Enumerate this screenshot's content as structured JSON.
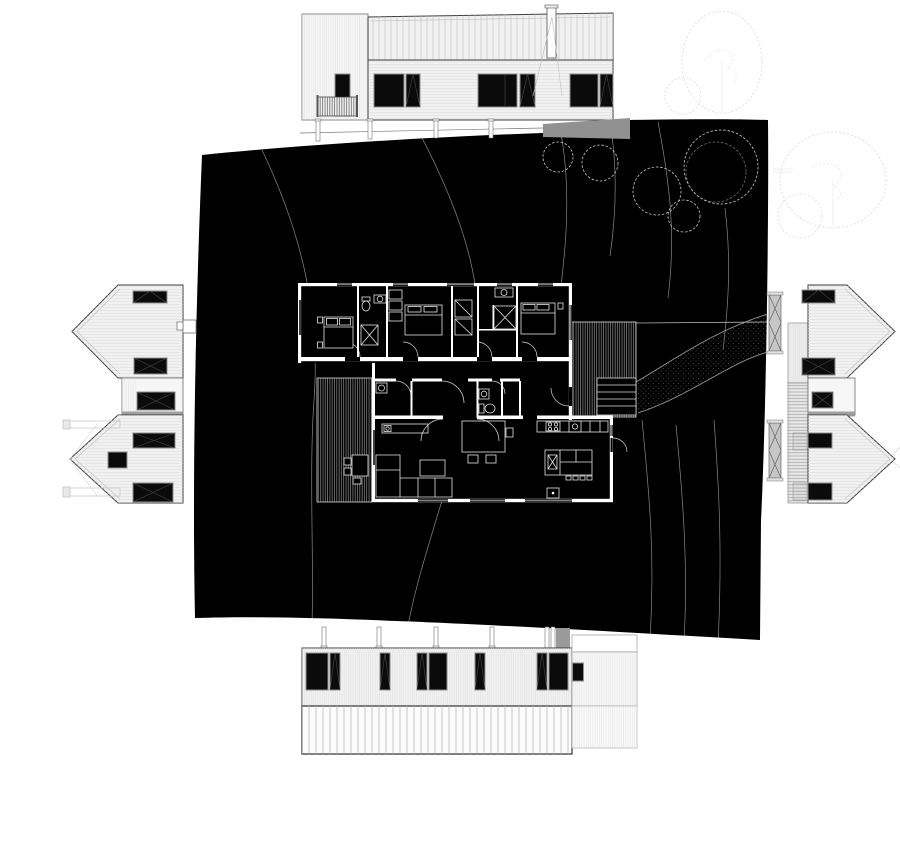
{
  "colors": {
    "paper": "#ffffff",
    "site": "#000000",
    "contour": "#8a8a8a",
    "plan-line": "#e4e4e4",
    "wall": "#ffffff",
    "elev-fill": "#f1f1f1",
    "elev-line": "#3c3c3c",
    "glass": "#0b0b0b",
    "frame": "#8f8f8f",
    "faint": "#e2e2e2",
    "shadow": "#919191"
  },
  "parts": [
    "site-plan",
    "floor-plan",
    "bedroom-wing",
    "living-wing",
    "west-deck",
    "east-deck",
    "deck-stairs",
    "access-path",
    "north-elevation",
    "south-elevation",
    "west-elevation-upper",
    "west-elevation-lower",
    "west-elevation-connector",
    "east-elevation-upper",
    "east-elevation-lower",
    "east-elevation-connector",
    "site-trees",
    "grove-trees",
    "contour-lines",
    "chimney",
    "balcony-railing",
    "foundation-posts"
  ]
}
